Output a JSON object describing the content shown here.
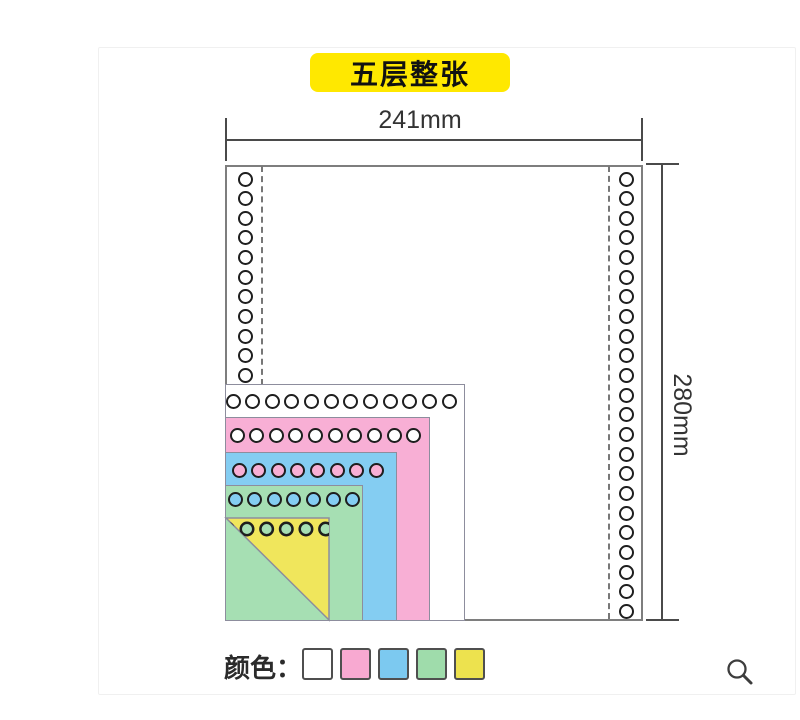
{
  "label": {
    "text": "五层整张",
    "bg": "#FFE800",
    "text_color": "#111111"
  },
  "dim_width": {
    "text": "241mm"
  },
  "dim_height": {
    "text": "280mm"
  },
  "legend": {
    "title": "颜色：",
    "swatches": [
      {
        "name": "white",
        "color": "#FFFFFF"
      },
      {
        "name": "pink",
        "color": "#F8A9D1"
      },
      {
        "name": "blue",
        "color": "#7CC9F0"
      },
      {
        "name": "green",
        "color": "#9FDCAB"
      },
      {
        "name": "yellow",
        "color": "#EDE24E"
      }
    ]
  },
  "colors": {
    "hole_ring": "#1E1E1E",
    "sheet_border": "#7E7E7E",
    "layer_border": "#8D8D9D",
    "dashed_line": "#777777",
    "dimension": "#4A4A4A"
  },
  "diagram": {
    "sheet": {
      "x": 225,
      "y": 165,
      "w": 418,
      "h": 456
    },
    "hole": {
      "d": 15,
      "ring": 2.5,
      "step": 19.65
    },
    "columns": [
      {
        "name": "left-hole-column",
        "cx": 245,
        "y0": 179,
        "count": 11
      },
      {
        "name": "right-hole-column",
        "cx": 626,
        "y0": 179,
        "count": 23
      }
    ],
    "dashed_lines": [
      {
        "name": "left-perforation-line",
        "x": 261,
        "y1": 166,
        "y2": 385
      },
      {
        "name": "right-perforation-line",
        "x": 608,
        "y1": 166,
        "y2": 619
      }
    ],
    "left": 225,
    "bottom": 621,
    "layers": [
      {
        "name": "layer-1-white",
        "color": "#FFFFFF",
        "top": 384,
        "right": 465,
        "hole_fill": "#FFFFFF",
        "row": {
          "x0": 233,
          "y": 401,
          "count": 12
        }
      },
      {
        "name": "layer-2-pink",
        "color": "#F8AFD5",
        "top": 417,
        "right": 430,
        "hole_fill": "#FFFFFF",
        "row": {
          "x0": 237,
          "y": 435,
          "count": 10
        }
      },
      {
        "name": "layer-3-blue",
        "color": "#84CDF2",
        "top": 452,
        "right": 397,
        "hole_fill": "#F8AFD5",
        "row": {
          "x0": 239,
          "y": 470,
          "count": 8
        }
      },
      {
        "name": "layer-4-green",
        "color": "#A6DFB3",
        "top": 485,
        "right": 363,
        "hole_fill": "#84CDF2",
        "row": {
          "x0": 235,
          "y": 499,
          "count": 7
        }
      },
      {
        "name": "layer-5-yellow",
        "color": "#F0E65C",
        "top": 517,
        "right": 330,
        "hole_fill": "#A6DFB3",
        "row": {
          "x0": 247,
          "y": 529,
          "count": 5
        },
        "diagonal_cut": true
      }
    ]
  }
}
